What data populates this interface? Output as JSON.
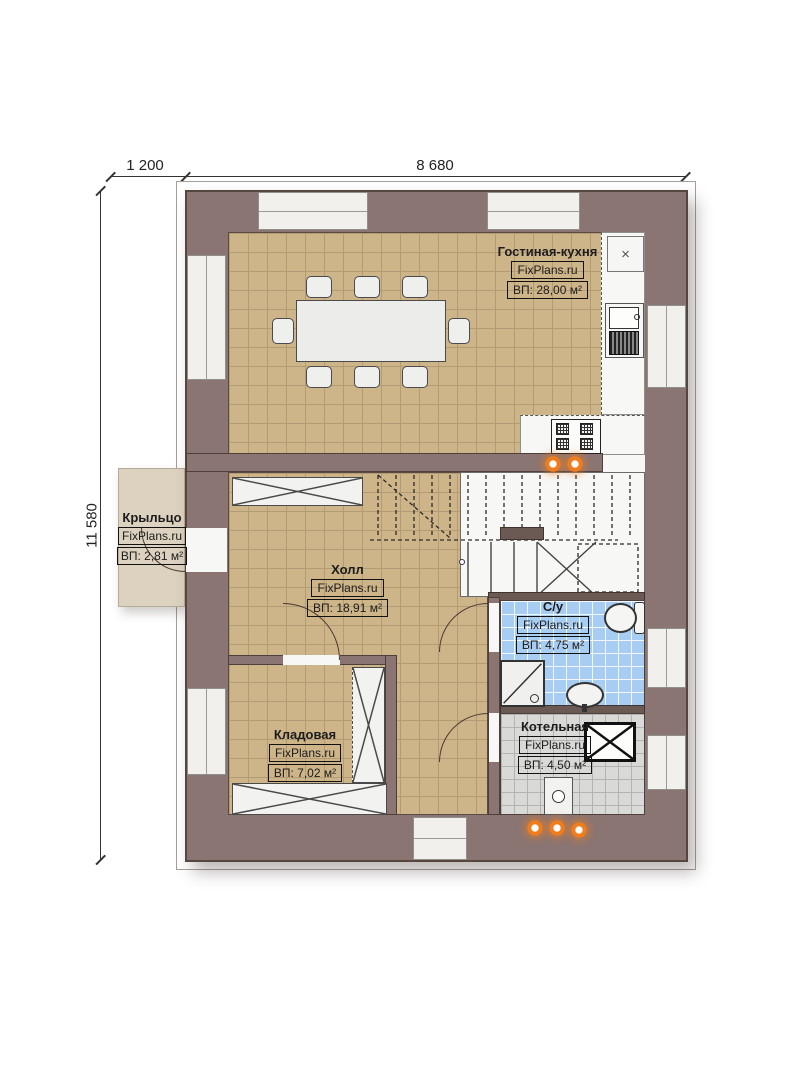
{
  "dimensions": {
    "porch_width": "1 200",
    "house_width": "8 680",
    "house_height": "11 580"
  },
  "rooms": [
    {
      "id": "living-kitchen",
      "name": "Гостиная-кухня",
      "brand": "FixPlans.ru",
      "area": "ВП: 28,00 м²"
    },
    {
      "id": "porch",
      "name": "Крыльцо",
      "brand": "FixPlans.ru",
      "area": "ВП: 2,81 м²"
    },
    {
      "id": "hall",
      "name": "Холл",
      "brand": "FixPlans.ru",
      "area": "ВП: 18,91 м²"
    },
    {
      "id": "bathroom",
      "name": "С/у",
      "brand": "FixPlans.ru",
      "area": "ВП: 4,75 м²"
    },
    {
      "id": "storage",
      "name": "Кладовая",
      "brand": "FixPlans.ru",
      "area": "ВП: 7,02 м²"
    },
    {
      "id": "boiler",
      "name": "Котельная",
      "brand": "FixPlans.ru",
      "area": "ВП: 4,50 м²"
    }
  ],
  "fixtures": {
    "fridge_symbol": "×"
  },
  "colors": {
    "wall": "#8b7572",
    "floor_tan": "#cdb489",
    "bathroom_blue": "#a8cdf2",
    "boiler_gray": "#d9d9d7",
    "porch_beige": "#ddd2bf",
    "radiator_orange": "#ef7d1e"
  }
}
